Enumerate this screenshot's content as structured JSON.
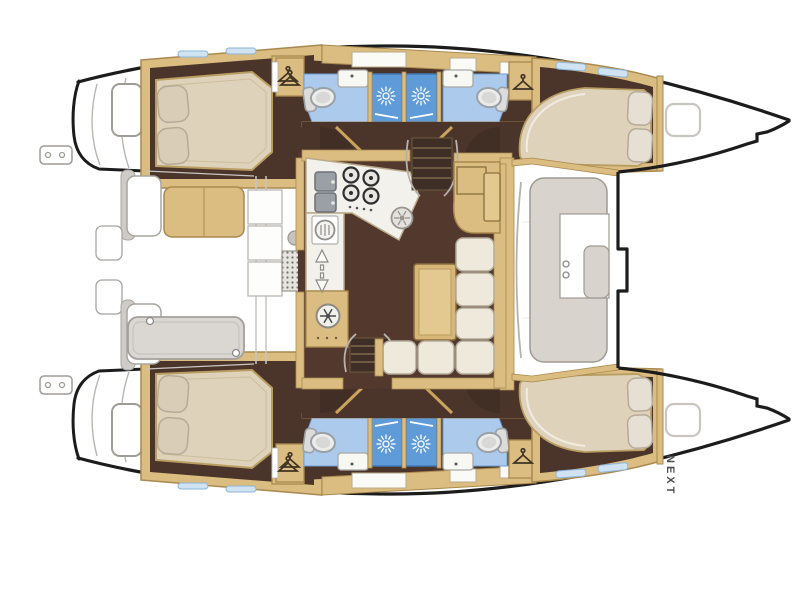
{
  "page": {
    "background": "#ffffff",
    "description": "Catamaran interior layout floor plan, top view, bow to the right"
  },
  "labels": {
    "next": "NEXT"
  },
  "colors": {
    "hull_outline": "#1c1c1c",
    "wood_trim": "#dcbd81",
    "wood_light": "#e3c88f",
    "floor_dark_brown": "#4b352b",
    "salon_floor": "#53392d",
    "bed_beige": "#ded2ba",
    "pillow": "#d9cdb8",
    "sofa_cream": "#efe9dc",
    "bathroom_floor_blue": "#abcaec",
    "shower_blue": "#5e9bd8",
    "deck_taupe": "#d8d3cc",
    "outline_gray": "#9f9c97"
  },
  "icons": {
    "hanger": "hanger-icon",
    "shower": "sunburst-shower-icon",
    "fridge": "snowflake-icon",
    "companionway": "double-arrow-icon",
    "stove": "four-burner-icon"
  }
}
